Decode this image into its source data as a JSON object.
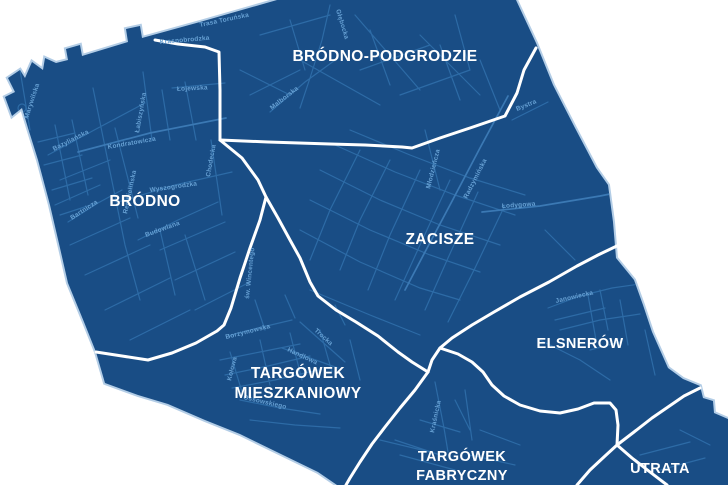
{
  "colors": {
    "background": "#ffffff",
    "district_fill": "#194d85",
    "district_halo": "#b3cde6",
    "boundary_line": "#ffffff",
    "street_line": "#2d6ba6",
    "street_major": "#3b79b4",
    "street_label": "#67a1d4",
    "neighborhood_label": "#ffffff"
  },
  "neighborhoods": [
    {
      "name": "BRÓDNO-PODGRODZIE"
    },
    {
      "name": "BRÓDNO"
    },
    {
      "name": "ZACISZE"
    },
    {
      "name": "ELSNERÓW"
    },
    {
      "lines": [
        "TARGÓWEK",
        "MIESZKANIOWY"
      ]
    },
    {
      "lines": [
        "TARGÓWEK",
        "FABRYCZNY"
      ]
    },
    {
      "name": "UTRATA"
    }
  ],
  "streets": [
    {
      "name": "Trasa Toruńska"
    },
    {
      "name": "Krasnobrodzka"
    },
    {
      "name": "Łojewska"
    },
    {
      "name": "Głębocka"
    },
    {
      "name": "Malborska"
    },
    {
      "name": "Łabiszyńska"
    },
    {
      "name": "Kondratowicza"
    },
    {
      "name": "Bazyliańska"
    },
    {
      "name": "Rembielińska"
    },
    {
      "name": "Chodecka"
    },
    {
      "name": "Wyszogrodzka"
    },
    {
      "name": "Bartnicza"
    },
    {
      "name": "Budowlana"
    },
    {
      "name": "Marywilska"
    },
    {
      "name": "św. Wincentego"
    },
    {
      "name": "Borzymowska"
    },
    {
      "name": "Trocka"
    },
    {
      "name": "Handlowa"
    },
    {
      "name": "Kołowa"
    },
    {
      "name": "Ossowskiego"
    },
    {
      "name": "Młodzieńcza"
    },
    {
      "name": "Radzymińska"
    },
    {
      "name": "Łodygowa"
    },
    {
      "name": "Bystra"
    },
    {
      "name": "Janowiecka"
    },
    {
      "name": "Kraśnicka"
    }
  ]
}
